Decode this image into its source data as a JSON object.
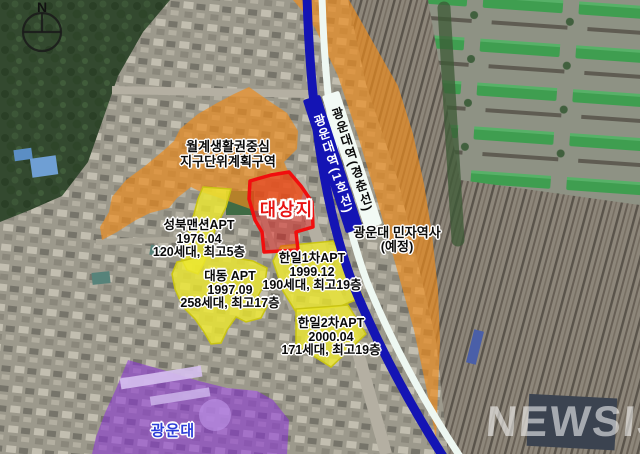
{
  "map": {
    "compass_label": "N",
    "watermark": "NEWSIS"
  },
  "railway": {
    "line1_station_label": "광운대역(1호선)",
    "gyeongchun_station_label": "광운대역(경춘선)",
    "private_station_name": "광운대 민자역사",
    "private_station_status": "(예정)"
  },
  "district_zone": {
    "name_line1": "월계생활권중심",
    "name_line2": "지구단위계획구역"
  },
  "target_site": {
    "label": "대상지"
  },
  "apartments": [
    {
      "name": "성북맨션APT",
      "date": "1976.04",
      "detail": "120세대, 최고5층"
    },
    {
      "name": "대동 APT",
      "date": "1997.09",
      "detail": "258세대, 최고17층"
    },
    {
      "name": "한일1차APT",
      "date": "1999.12",
      "detail": "190세대, 최고19층"
    },
    {
      "name": "한일2차APT",
      "date": "2000.04",
      "detail": "171세대, 최고19층"
    }
  ],
  "university": {
    "label": "광운대"
  },
  "colors": {
    "district_orange": "#ED8C1E",
    "apartment_yellow": "#EDE92E",
    "target_red": "#F10E0E",
    "university_purple": "#8C32DC",
    "line1_blue": "#1414B4",
    "gyeongchun_white": "#EEF8F2"
  }
}
